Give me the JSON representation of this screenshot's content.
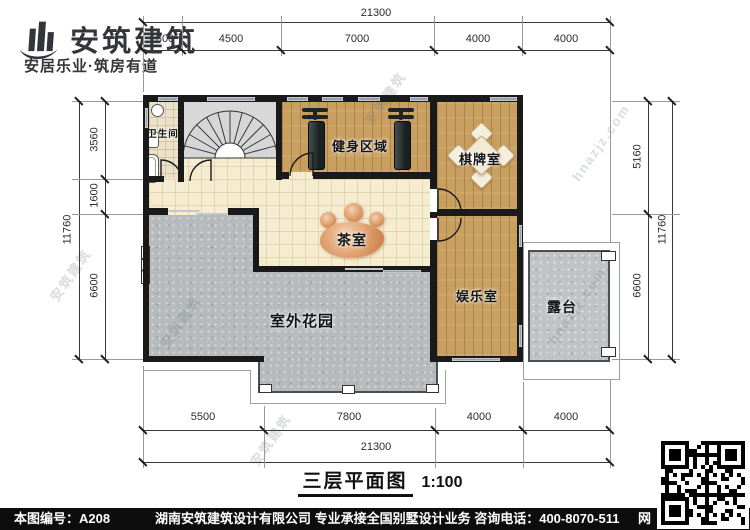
{
  "logo": {
    "title": "安筑建筑",
    "tagline": "安居乐业·筑房有道"
  },
  "plan": {
    "rooms": {
      "bathroom": "卫生间",
      "gym": "健身区域",
      "chess": "棋牌室",
      "tea": "茶室",
      "entertainment": "娱乐室",
      "garden": "室外花园",
      "terrace": "露台"
    }
  },
  "dimensions": {
    "top": {
      "total": "21300",
      "segments": [
        "1800",
        "4500",
        "7000",
        "4000",
        "4000"
      ]
    },
    "bottom": {
      "total": "21300",
      "segments": [
        "5500",
        "7800",
        "4000",
        "4000"
      ]
    },
    "left": {
      "total": "11760",
      "segments": [
        "3560",
        "1600",
        "6600"
      ]
    },
    "right": {
      "total": "11760",
      "segments": [
        "5160",
        "6600"
      ]
    }
  },
  "title_block": {
    "name": "三层平面图",
    "scale": "1:100"
  },
  "footer": {
    "drawing_no": "本图编号：A208",
    "company_line": "湖南安筑建筑设计有限公司  专业承接全国别墅设计业务  咨询电话：400-8070-511",
    "web_label": "网"
  },
  "watermarks": {
    "cn": "安筑建筑",
    "en": "hnazjz.com"
  },
  "colors": {
    "wall": "#1a1a1a",
    "wood_floor": "#c99f5f",
    "tile_floor": "#f5ecd2",
    "stone_floor": "#b7babc",
    "accent_wood": "#dd9a68"
  }
}
